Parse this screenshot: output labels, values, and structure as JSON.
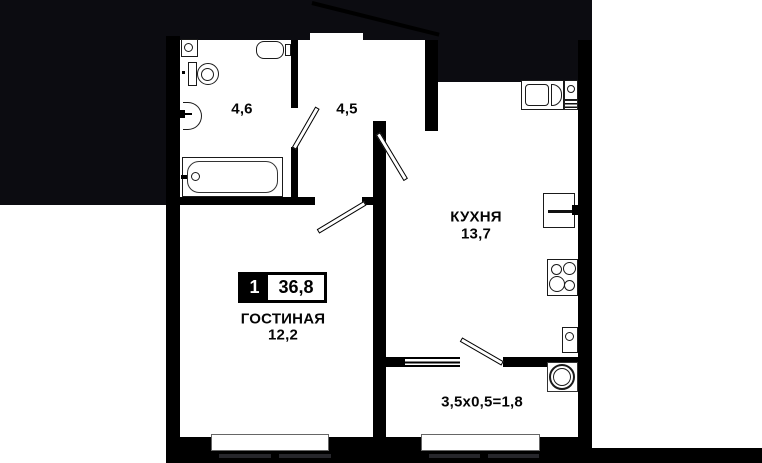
{
  "badge": {
    "rooms_count": "1",
    "total_area": "36,8"
  },
  "rooms": {
    "bathroom": {
      "area": "4,6"
    },
    "hallway": {
      "area": "4,5"
    },
    "kitchen": {
      "name": "КУХНЯ",
      "area": "13,7"
    },
    "living_room": {
      "name": "ГОСТИНАЯ",
      "area": "12,2"
    },
    "balcony": {
      "dimensions": "3,5x0,5=1,8"
    }
  },
  "fixtures": [
    "washing-machine",
    "toilet",
    "wash-basin",
    "bathtub",
    "water-heater",
    "kitchen-sink",
    "fridge",
    "stove",
    "boiler",
    "air-conditioner"
  ],
  "colors": {
    "paper": "#ffffff",
    "silhouette": "#0c0c11",
    "wall": "#000000"
  }
}
